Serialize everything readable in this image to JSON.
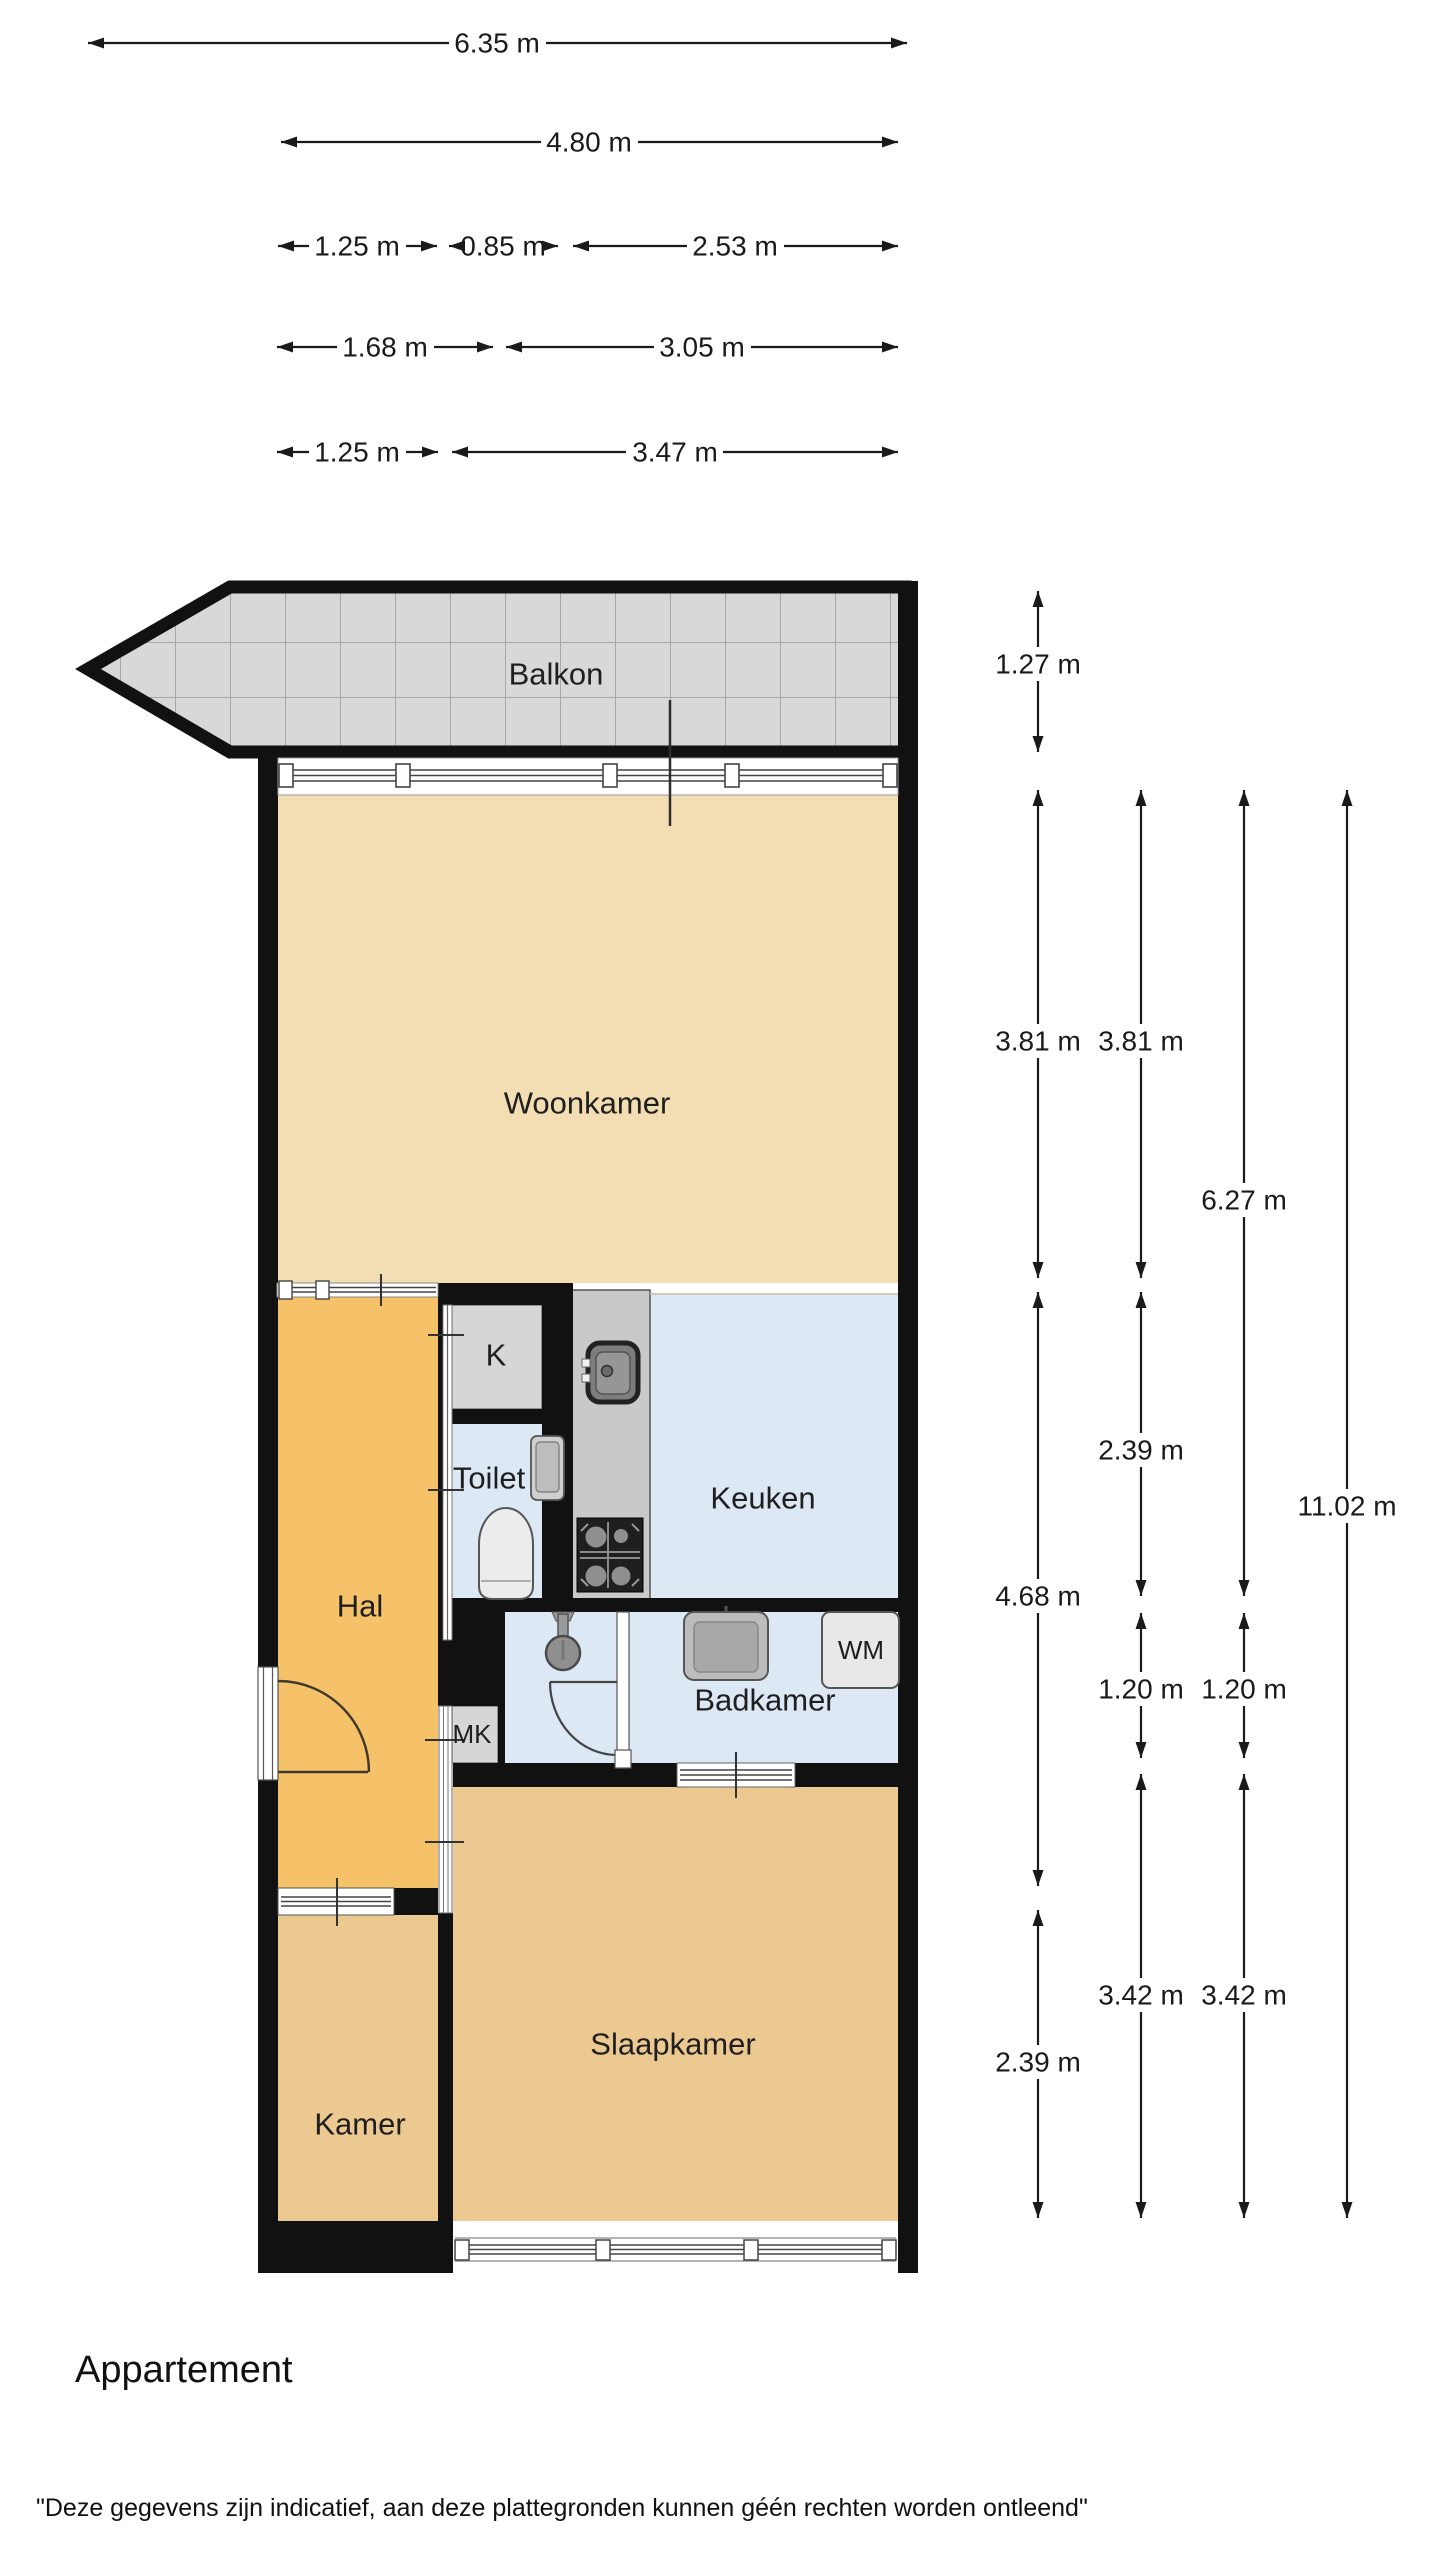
{
  "footer": {
    "title": "Appartement",
    "disclaimer": "\"Deze gegevens zijn indicatief, aan deze plattegronden kunnen géén rechten worden ontleend\""
  },
  "rooms": {
    "balkon": "Balkon",
    "woonkamer": "Woonkamer",
    "keuken": "Keuken",
    "toilet": "Toilet",
    "closet_k": "K",
    "hal": "Hal",
    "closet_mk": "MK",
    "badkamer": "Badkamer",
    "wasmachine": "WM",
    "slaapkamer": "Slaapkamer",
    "kamer": "Kamer"
  },
  "dims": {
    "top": [
      {
        "label": "6.35 m"
      },
      {
        "label": "4.80 m"
      },
      {
        "label": "1.25 m"
      },
      {
        "label": "0.85 m"
      },
      {
        "label": "2.53 m"
      },
      {
        "label": "1.68 m"
      },
      {
        "label": "3.05 m"
      },
      {
        "label": "1.25 m"
      },
      {
        "label": "3.47 m"
      }
    ],
    "right": [
      {
        "label": "1.27 m"
      },
      {
        "label": "3.81 m"
      },
      {
        "label": "4.68 m"
      },
      {
        "label": "2.39 m"
      },
      {
        "label": "3.81 m"
      },
      {
        "label": "2.39 m"
      },
      {
        "label": "1.20 m"
      },
      {
        "label": "3.42 m"
      },
      {
        "label": "6.27 m"
      },
      {
        "label": "1.20 m"
      },
      {
        "label": "3.42 m"
      },
      {
        "label": "11.02 m"
      }
    ]
  },
  "colors": {
    "wall": "#111111",
    "living": "#f3ddb2",
    "hall": "#f6c269",
    "bedroom": "#edc992",
    "wet_room": "#dce8f4",
    "closet": "#d6d6d6",
    "counter": "#c9c9c9",
    "balcony": "#d8d8d8",
    "dimension": "#1a1a1a"
  }
}
